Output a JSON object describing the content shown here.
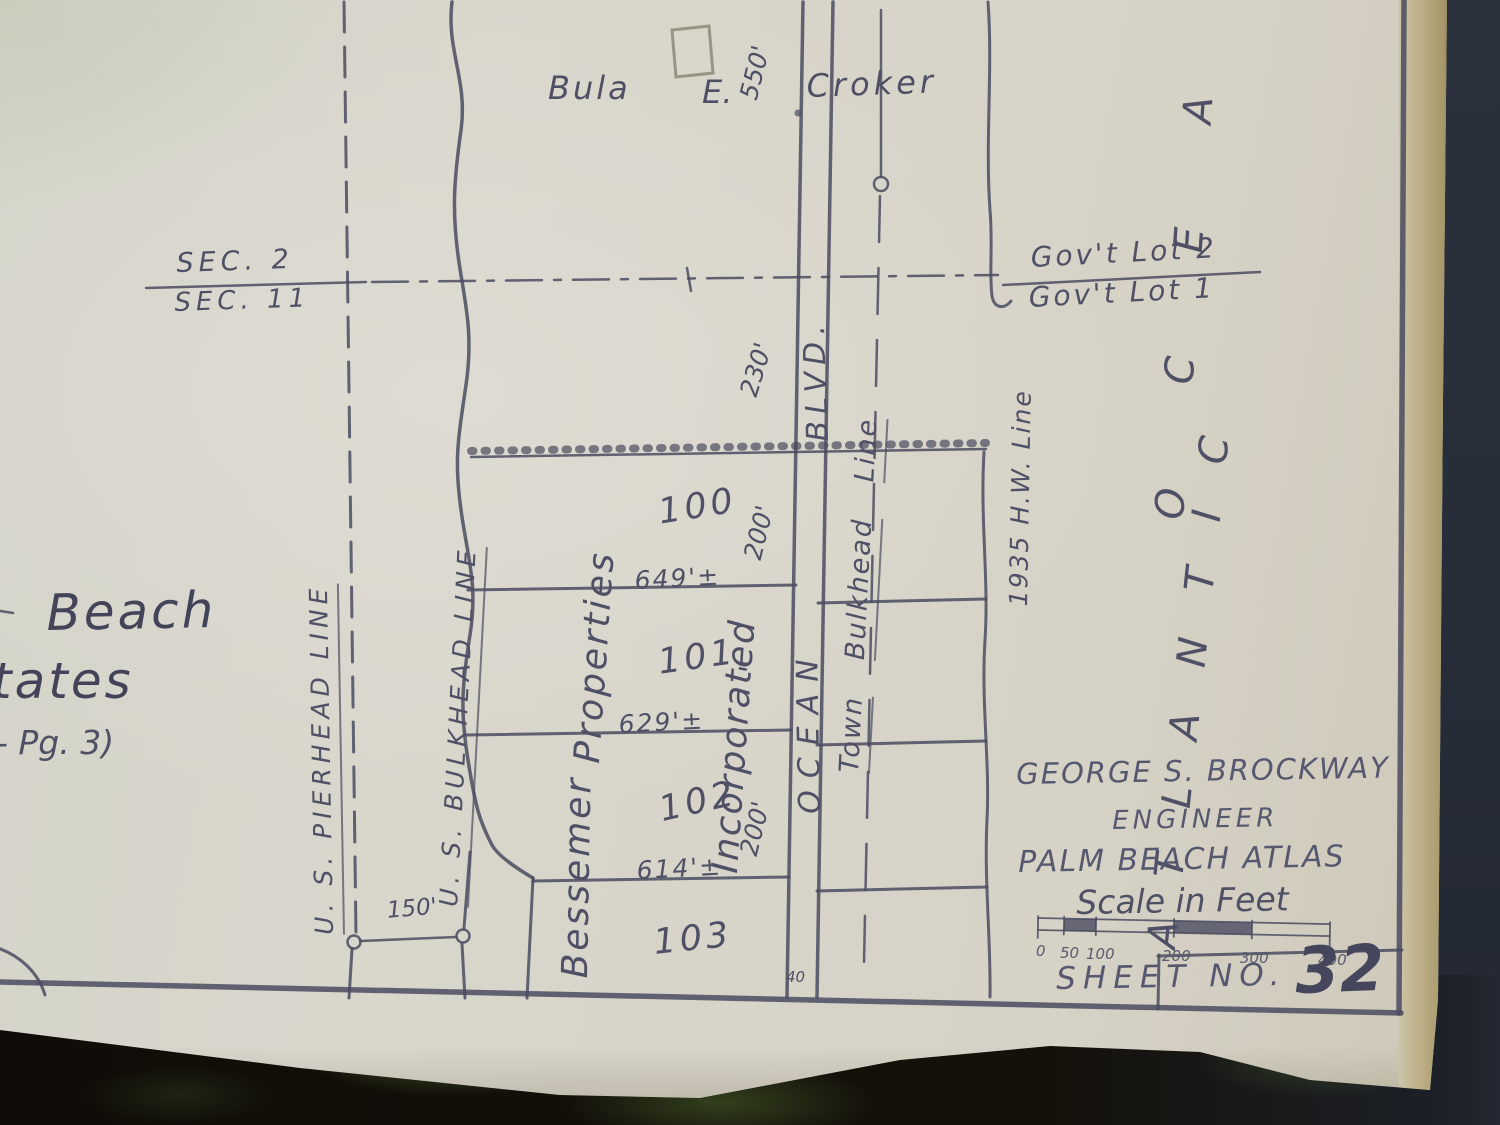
{
  "photo": {
    "description": "photograph of an old plat map sheet on a dark table",
    "colors": {
      "paper": "#d8d5cb",
      "ink": "#4a4b60",
      "background": "#272d38",
      "table": "#14110a",
      "moss_highlight": "#52702f",
      "paper_edge_tan": "#a6976a"
    }
  },
  "map": {
    "section_fraction": {
      "upper": "SEC. 2",
      "lower": "SEC. 11"
    },
    "gov_lot_fraction": {
      "upper": "Gov't Lot 2",
      "lower": "Gov't Lot 1"
    },
    "owner": {
      "first": "Bula",
      "middle": "E.",
      "last": "Croker"
    },
    "edge_text": {
      "line1": "Beach",
      "line2": "tates",
      "line3": "- Pg. 3)"
    },
    "line_labels": {
      "pierhead": "U. S. PIERHEAD LINE",
      "bulkhead": "U. S. BULKHEAD LINE",
      "town_w1": "Town",
      "town_w2": "Bulkhead",
      "town_w3": "Line",
      "hw_line": "1935 H.W. Line",
      "street_name": "OCEAN",
      "street_type": "BLVD."
    },
    "water": {
      "word1": "ATLANTIC",
      "word2": "OCEAN"
    },
    "company": {
      "name1": "Bessemer",
      "name2": "Properties",
      "name3": "Incorporated",
      "ditto": "\""
    },
    "lots": {
      "l100": "100",
      "l101": "101",
      "l102": "102",
      "l103": "103"
    },
    "dimensions": {
      "d550": "550'",
      "d230": "230'",
      "d200_a": "200'",
      "d200_b": "200'",
      "d649": "649'±",
      "d629": "629'±",
      "d614": "614'±",
      "d150": "150'",
      "d40": "40"
    },
    "title_block": {
      "engineer_name": "GEORGE S. BROCKWAY",
      "engineer_title": "ENGINEER",
      "atlas_title": "PALM BEACH ATLAS",
      "scale_label": "Scale in Feet",
      "scale_ticks": {
        "t0": "0",
        "t50": "50",
        "t100": "100",
        "t200": "200",
        "t300": "300",
        "t400": "400"
      },
      "sheet_label": "SHEET  NO.",
      "sheet_number": "32"
    }
  }
}
